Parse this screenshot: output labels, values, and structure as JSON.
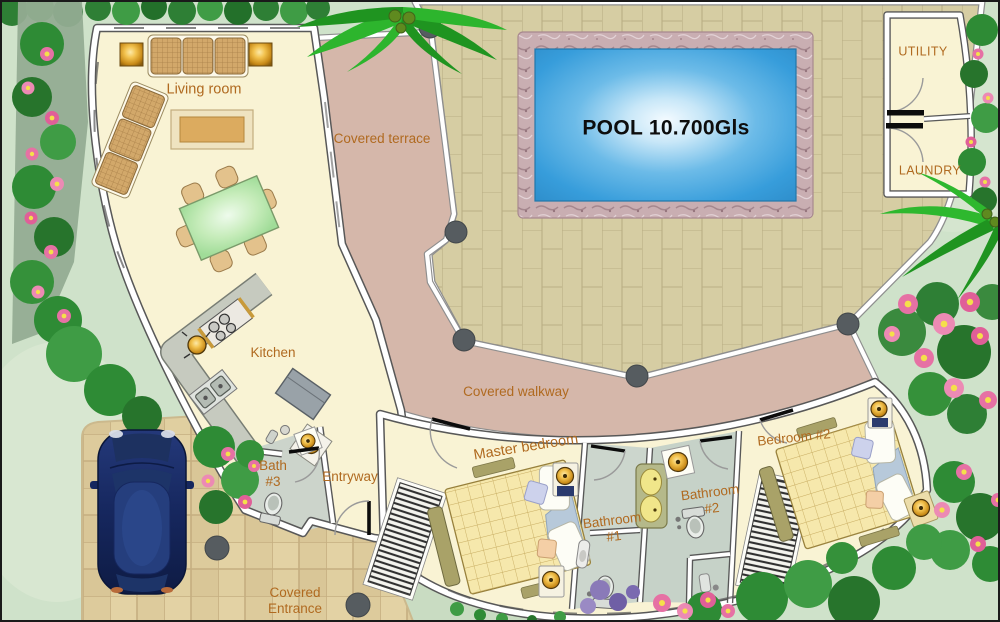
{
  "plan_title": "Villa floor plan with pool",
  "labels": {
    "living_room": "Living room",
    "covered_terrace": "Covered terrace",
    "covered_walkway": "Covered walkway",
    "covered_entrance": [
      "Covered",
      "Entrance"
    ],
    "pool": "POOL 10.700Gls",
    "utility": "UTILITY",
    "laundry": "LAUNDRY",
    "kitchen": "Kitchen",
    "bath3": [
      "Bath",
      "#3"
    ],
    "entryway": "Entryway",
    "master_bedroom": "Master bedroom",
    "bathroom1": [
      "Bathroom",
      "#1"
    ],
    "bathroom2": [
      "Bathroom",
      "#2"
    ],
    "bedroom2": "Bedroom #2"
  },
  "colors": {
    "label_text": "#b06a20",
    "pool_text": "#0d0d0d",
    "pool_water": "#3aa0dc",
    "pool_stone_border": "#c9aeb2",
    "walkway_terrace": "#d5b7aa",
    "patio_tile": "#d6cda3",
    "driveway_tile": "#e3d2a4",
    "room_floor": "#f9f3d4",
    "bathroom_floor": "#ccd6cd",
    "lawn": "#cfe2ca",
    "foliage": "#2e8b35",
    "flower_pink": "#e671a4",
    "car_body": "#16275e",
    "wall_white": "#ffffff",
    "column_gray": "#565c60"
  }
}
